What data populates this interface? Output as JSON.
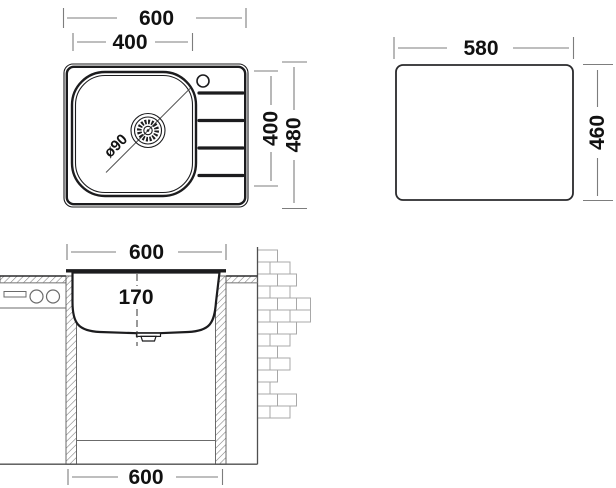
{
  "top_view": {
    "overall_width": "600",
    "bowl_width": "400",
    "bowl_depth": "400",
    "overall_depth": "480",
    "drain_diameter": "ø90"
  },
  "cutout_view": {
    "width": "580",
    "height": "460"
  },
  "section_view": {
    "top_width": "600",
    "bowl_depth": "170",
    "bottom_width": "600"
  },
  "colors": {
    "outline": "#1c1c1e",
    "dimension_line": "#7d7d7d",
    "label_text": "#111111",
    "brick_line": "#a8a8a8",
    "hatch_line": "#777777",
    "background": "#ffffff"
  }
}
